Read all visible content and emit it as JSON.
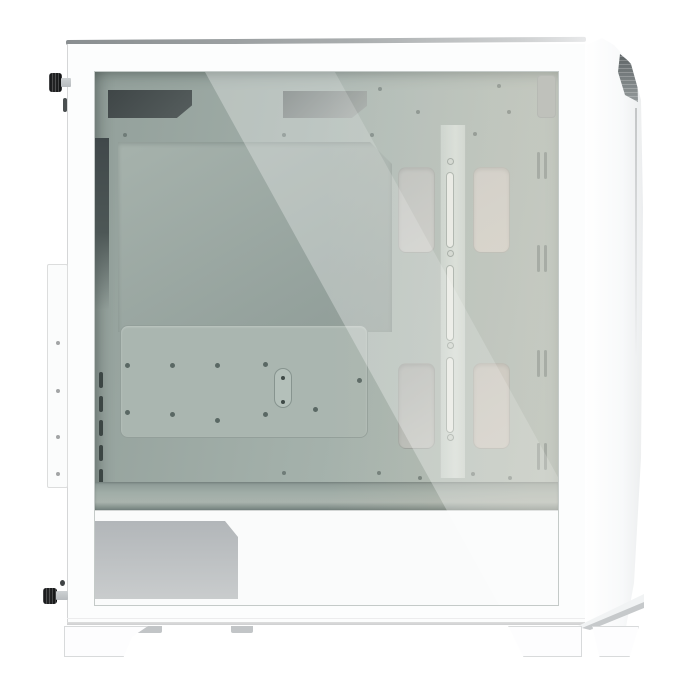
{
  "scene": {
    "type": "product-photo",
    "subject": "White mid-tower PC case, left side view, tempered glass side panel showing empty interior",
    "background": "#ffffff",
    "visible_parts": [
      "top panel edge",
      "tempered glass side panel",
      "rear thumbscrews (2, black)",
      "rear expansion-slot vents",
      "motherboard tray with standoff holes",
      "cable routing cutouts (2 top, 4 side grommets)",
      "vertical cable management bar with slots",
      "front fan mounting slits",
      "PSU shroud with ventilation mesh",
      "rear I/O bracket",
      "angular front panel with dark mesh accent",
      "case feet (2) with small tabs",
      "front foot with folded accent"
    ]
  },
  "palette": {
    "bg": "#ffffff",
    "case-white": "#fcfdfd",
    "edge-mid": "#d5d6d7",
    "interior-left": "#93a09b",
    "interior-mid": "#a2afa9",
    "interior-right": "#b2beb8",
    "reflection-white": "rgba(255,255,255,0.30)",
    "reflection-soft": "rgba(255,255,255,0.16)",
    "warm-tint": "rgba(213,202,180,0.28)",
    "vent-slot-dark": "#3c4644",
    "plate-green": "#aab6b0",
    "hole-dark": "#5a6864",
    "slot-fill": "#e9ede9",
    "floor-dark": "#73817d",
    "shroud-white": "#fafbfb",
    "psu-vent-top": "#b2b6b9",
    "psu-vent-bottom": "#c9cccd",
    "screw-black": "#242526",
    "screw-silver": "#b7bbbe",
    "foot-border": "#d8dadb",
    "tab-gray": "#c2c5c7",
    "front-vent-dark": "#5c6264"
  }
}
